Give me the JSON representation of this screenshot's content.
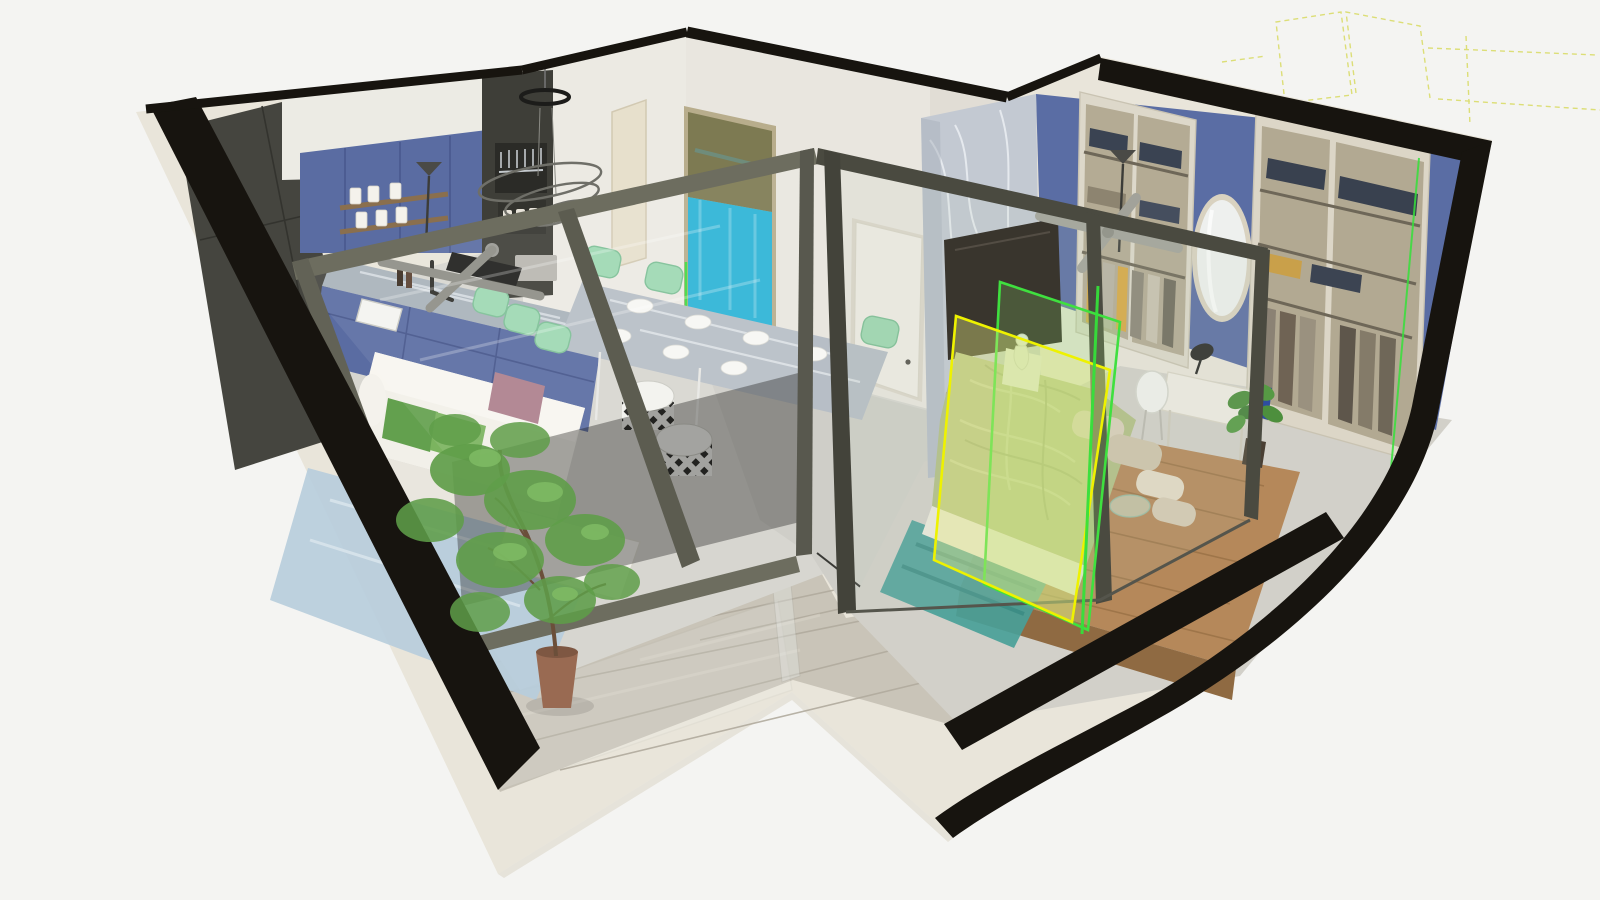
{
  "scene": {
    "subject": "Photorealistic 3D cutaway (dollhouse) render of a one-bedroom apartment viewed from above at a three-quarter angle",
    "view": "elevated axonometric cutaway; walls sliced with black cut faces and cream outer shell on plain light-grey background",
    "annotations": {
      "selected_panel": "glass partition pane of the bedroom highlighted with bright green and yellow selection outlines",
      "laser_lines": "thin bright green construction lines on the glass edge and inside the right wardrobe",
      "guide_lines": "faint dashed yellow construction wireframe floating above the top-right walls"
    }
  },
  "rooms": {
    "living_kitchen": {
      "label": "living room with open kitchen and dining",
      "items": [
        "dark charcoal wardrobe along left wall",
        "white upper kitchen cabinets",
        "royal-blue kitchen cabinets with timber open shelves and white canisters",
        "blue-grey marble island worktop with inset sink and black tap, dark cooktop",
        "marble dining table with white plates",
        "mint-green dining and bar chairs",
        "white fabric sofa with green and dusty-pink cushions",
        "pale-blue rug and white coffee table",
        "two black-and-white diamond-patterned poufs",
        "ring pendant lamp and spiral chandelier",
        "teal abstract painting on rear wall",
        "grey ceiling fan",
        "cream entry door"
      ]
    },
    "hallway": {
      "label": "hallway between rooms",
      "items": [
        "white door to bedroom",
        "green LED corner strip",
        "concrete-look floor"
      ]
    },
    "bedroom": {
      "label": "bedroom with open wardrobe wall",
      "items": [
        "grey marble feature wall with dark TV panel",
        "blue feature wall",
        "cream open wardrobe with folded denim stacks and hanging clothes",
        "tall oval mirror",
        "torchiere lamp and grey ceiling fan",
        "platform bed on timber deck with sage-green rumpled duvet and beige pillows",
        "low brick plinth and white figurine at bed head",
        "teal runner rug",
        "glass bowl, fiddle-leaf plant in dark pot",
        "white desk with black lamp and white chair",
        "second cream wardrobe with coats and green laser line"
      ]
    },
    "balcony": {
      "label": "wrap-around balcony / terrace",
      "items": [
        "grey timber-look tile deck",
        "frameless glass balustrade",
        "indoor tree in terracotta pot",
        "smoked-glass sliding door"
      ]
    }
  },
  "colors": {
    "background": "#f4f4f2",
    "shell_cream": "#e9e5da",
    "cut_black": "#17140f",
    "charcoal_cabinet": "#45453f",
    "kitchen_blue": "#5a6ca2",
    "wall_blue": "#5a6da4",
    "counter_marble": "#a9b2ba",
    "marble_wall": "#c3c9d2",
    "mint_chair": "#9ed8b2",
    "sofa_white": "#f2f0e9",
    "pillow_green": "#63a04e",
    "pillow_green2": "#7bb45f",
    "pillow_pink": "#ad7f8d",
    "rug_blue": "#b7cddc",
    "rug_teal": "#49a098",
    "duvet_sage": "#b3bf86",
    "platform_wood": "#b5885a",
    "deck_grey": "#c9c4b8",
    "painting_teal": "#2cb3d6",
    "terracotta_pot": "#996a52",
    "foliage_green": "#5f9d49",
    "frame_olive": "#6d6d5f",
    "frame_dark": "#4a4a40",
    "select_green": "#3fe03f",
    "select_yellow": "#eef200",
    "laser_green": "#35e03a",
    "guide_yellow": "#d4d74e",
    "tv_panel": "#241d17",
    "floor_grey": "#d7d6d0"
  }
}
